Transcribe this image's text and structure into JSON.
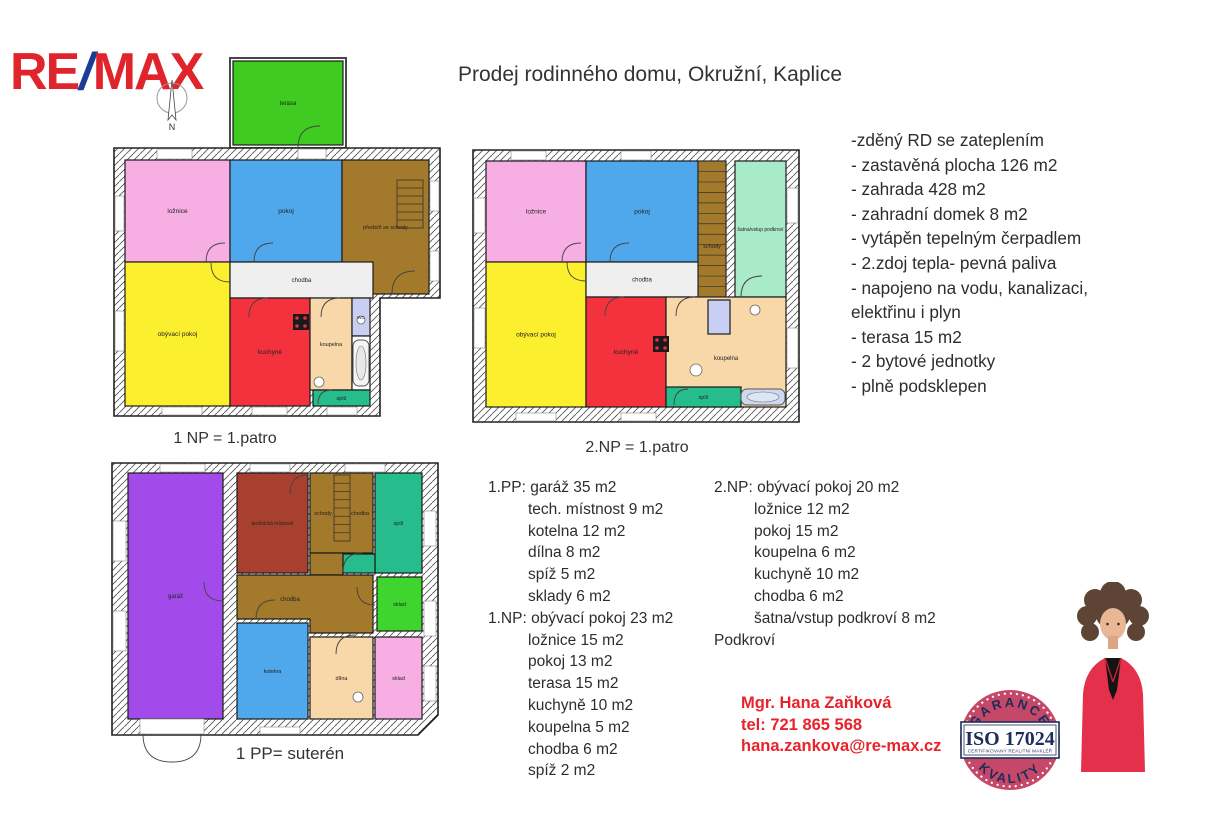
{
  "brand": {
    "re": "RE",
    "slash": "/",
    "max": "MAX"
  },
  "compass": {
    "n": "N"
  },
  "title": "Prodej rodinného domu, Okružní, Kaplice",
  "features": {
    "lines": [
      "-zděný RD se zateplením",
      "- zastavěná plocha 126 m2",
      "- zahrada 428 m2",
      "- zahradní domek 8 m2",
      "- vytápěn tepelným čerpadlem",
      "- 2.zdoj tepla- pevná paliva",
      "- napojeno na vodu, kanalizaci,",
      "elektřinu i plyn",
      "- terasa 15 m2",
      "- 2 bytové jednotky",
      "- plně podsklepen"
    ]
  },
  "room_lists": {
    "left": [
      {
        "t": "1.PP: garáž 35 m2",
        "i": 0
      },
      {
        "t": "tech. místnost 9 m2",
        "i": 1
      },
      {
        "t": "kotelna 12 m2",
        "i": 1
      },
      {
        "t": "dílna 8 m2",
        "i": 1
      },
      {
        "t": "spíž 5 m2",
        "i": 1
      },
      {
        "t": "sklady 6 m2",
        "i": 1
      },
      {
        "t": "1.NP: obývací pokoj 23 m2",
        "i": 0
      },
      {
        "t": "ložnice 15 m2",
        "i": 1
      },
      {
        "t": "pokoj 13 m2",
        "i": 1
      },
      {
        "t": "terasa 15 m2",
        "i": 1
      },
      {
        "t": "kuchyně 10 m2",
        "i": 1
      },
      {
        "t": "koupelna 5 m2",
        "i": 1
      },
      {
        "t": "chodba 6 m2",
        "i": 1
      },
      {
        "t": "spíž 2 m2",
        "i": 1
      }
    ],
    "right": [
      {
        "t": "2.NP: obývací pokoj 20 m2",
        "i": 0
      },
      {
        "t": "ložnice 12 m2",
        "i": 1
      },
      {
        "t": "pokoj 15 m2",
        "i": 1
      },
      {
        "t": "koupelna 6 m2",
        "i": 1
      },
      {
        "t": "kuchyně 10 m2",
        "i": 1
      },
      {
        "t": "chodba 6 m2",
        "i": 1
      },
      {
        "t": "šatna/vstup podkroví 8 m2",
        "i": 1
      },
      {
        "t": "Podkroví",
        "i": 0
      }
    ]
  },
  "agent": {
    "name": "Mgr. Hana Zaňková",
    "phone": "tel: 721 865 568",
    "email": "hana.zankova@re-max.cz"
  },
  "badge": {
    "arc_top": "GARANCE",
    "arc_bottom": "KVALITY",
    "code": "ISO 17024",
    "subtitle": "CERTIFIKOVANÝ REALITNÍ MAKLÉŘ",
    "ring_color": "#c54868",
    "navy": "#1b2d5b"
  },
  "floor_plans": [
    {
      "id": "plan1",
      "caption": "1 NP = 1.patro",
      "pos": {
        "left": 112,
        "top": 56,
        "w": 330,
        "h": 368
      },
      "frames": [
        {
          "x": 118,
          "y": 2,
          "w": 116,
          "h": 90
        }
      ],
      "walls": [
        "2,92 328,92 328,242 268,242 268,360 2,360"
      ],
      "rooms": [
        {
          "label": "terasa",
          "color": "#3fcb20",
          "x": 121,
          "y": 5,
          "w": 110,
          "h": 84,
          "fs": 6
        },
        {
          "label": "ložnice",
          "color": "#f7aee3",
          "x": 13,
          "y": 104,
          "w": 105,
          "h": 102
        },
        {
          "label": "pokoj",
          "color": "#4fa8ec",
          "x": 118,
          "y": 104,
          "w": 112,
          "h": 102
        },
        {
          "label": "předsíň se schody",
          "color": "#a3792b",
          "x": 230,
          "y": 104,
          "w": 87,
          "h": 134,
          "fs": 5.5
        },
        {
          "label": "obývací pokoj",
          "color": "#fcef2e",
          "x": 13,
          "y": 206,
          "w": 105,
          "h": 144
        },
        {
          "label": "chodba",
          "color": "#efefef",
          "x": 118,
          "y": 206,
          "w": 143,
          "h": 36,
          "fs": 6
        },
        {
          "label": "kuchyně",
          "color": "#f4323e",
          "x": 118,
          "y": 242,
          "w": 80,
          "h": 108
        },
        {
          "label": "koupelna",
          "color": "#f8d8a8",
          "x": 198,
          "y": 242,
          "w": 42,
          "h": 92,
          "fs": 5.5
        },
        {
          "label": "WC",
          "color": "#c9cff2",
          "x": 240,
          "y": 242,
          "w": 18,
          "h": 38,
          "fs": 4.5
        },
        {
          "label": "",
          "color": "#ffffff",
          "x": 240,
          "y": 280,
          "w": 18,
          "h": 54
        },
        {
          "label": "spíž",
          "color": "#26bc8c",
          "x": 201,
          "y": 334,
          "w": 57,
          "h": 16,
          "fs": 5.5
        }
      ],
      "windows": [
        {
          "x": 45,
          "y": 93,
          "w": 35,
          "h": 10
        },
        {
          "x": 186,
          "y": 93,
          "w": 28,
          "h": 10
        },
        {
          "x": 3,
          "y": 140,
          "w": 9,
          "h": 35
        },
        {
          "x": 3,
          "y": 255,
          "w": 9,
          "h": 40
        },
        {
          "x": 50,
          "y": 351,
          "w": 40,
          "h": 8
        },
        {
          "x": 140,
          "y": 351,
          "w": 35,
          "h": 8
        },
        {
          "x": 215,
          "y": 351,
          "w": 30,
          "h": 8
        },
        {
          "x": 318,
          "y": 125,
          "w": 9,
          "h": 30
        },
        {
          "x": 318,
          "y": 195,
          "w": 9,
          "h": 30
        }
      ],
      "doors": [
        "M94,206 Q94,187 113,187",
        "M142,206 Q142,187 161,187",
        "M118,226 Q99,226 99,207",
        "M137,261 Q137,242 156,242",
        "M209,261 Q209,242 228,242",
        "M206,348 Q206,334 220,334",
        "M280,238 Q280,215 303,215",
        "M186,92 Q186,70 208,70"
      ],
      "fixtures": [
        {
          "type": "stairs-v",
          "x": 285,
          "y": 124,
          "w": 26,
          "h": 48,
          "n": 6
        },
        {
          "type": "tub-v",
          "x": 241,
          "y": 284,
          "w": 16,
          "h": 46
        },
        {
          "type": "stove",
          "x": 181,
          "y": 258,
          "w": 16,
          "h": 16
        },
        {
          "type": "basin",
          "x": 207,
          "y": 326,
          "r": 5
        },
        {
          "type": "basin",
          "x": 249,
          "y": 264,
          "r": 4
        }
      ],
      "texts": []
    },
    {
      "id": "plan2",
      "caption": "2.NP = 1.patro",
      "pos": {
        "left": 471,
        "top": 148,
        "w": 330,
        "h": 276
      },
      "frames": [],
      "walls": [
        "2,2 328,2 328,274 2,274"
      ],
      "rooms": [
        {
          "label": "ložnice",
          "color": "#f7aee3",
          "x": 15,
          "y": 13,
          "w": 100,
          "h": 101
        },
        {
          "label": "pokoj",
          "color": "#4fa8ec",
          "x": 115,
          "y": 13,
          "w": 112,
          "h": 101
        },
        {
          "label": "schody",
          "color": "#a3792b",
          "x": 227,
          "y": 13,
          "w": 28,
          "h": 136,
          "fs": 5.5,
          "ly": 100
        },
        {
          "label": "šatna/vstup podkroví",
          "color": "#a9ebc8",
          "x": 264,
          "y": 13,
          "w": 51,
          "h": 136,
          "fs": 5
        },
        {
          "label": "obývací pokoj",
          "color": "#fcef2e",
          "x": 15,
          "y": 114,
          "w": 100,
          "h": 145
        },
        {
          "label": "chodba",
          "color": "#efefef",
          "x": 115,
          "y": 114,
          "w": 112,
          "h": 35,
          "fs": 6
        },
        {
          "label": "kuchyně",
          "color": "#f4323e",
          "x": 115,
          "y": 149,
          "w": 80,
          "h": 110
        },
        {
          "label": "koupelna",
          "color": "#f8d8a8",
          "x": 195,
          "y": 149,
          "w": 120,
          "h": 110,
          "fs": 6,
          "ly": 212
        },
        {
          "label": "",
          "color": "#c9cff2",
          "x": 237,
          "y": 152,
          "w": 22,
          "h": 34
        },
        {
          "label": "spíž",
          "color": "#26bc8c",
          "x": 195,
          "y": 239,
          "w": 75,
          "h": 20,
          "fs": 5.5
        }
      ],
      "windows": [
        {
          "x": 40,
          "y": 3,
          "w": 35,
          "h": 9
        },
        {
          "x": 150,
          "y": 3,
          "w": 30,
          "h": 9
        },
        {
          "x": 3,
          "y": 50,
          "w": 11,
          "h": 35
        },
        {
          "x": 3,
          "y": 160,
          "w": 11,
          "h": 40
        },
        {
          "x": 45,
          "y": 265,
          "w": 40,
          "h": 8
        },
        {
          "x": 150,
          "y": 265,
          "w": 35,
          "h": 8
        },
        {
          "x": 316,
          "y": 40,
          "w": 11,
          "h": 35
        },
        {
          "x": 316,
          "y": 180,
          "w": 11,
          "h": 40
        }
      ],
      "doors": [
        "M91,114 Q91,95 110,95",
        "M139,114 Q139,95 158,95",
        "M115,133 Q96,133 96,114",
        "M134,168 Q134,149 153,149",
        "M205,168 Q205,149 224,149",
        "M270,149 Q270,128 291,128",
        "M203,257 Q203,241 217,241"
      ],
      "fixtures": [
        {
          "type": "stairs-v",
          "x": 227,
          "y": 13,
          "w": 28,
          "h": 136,
          "n": 13
        },
        {
          "type": "tub-h",
          "x": 270,
          "y": 241,
          "w": 44,
          "h": 16
        },
        {
          "type": "stove",
          "x": 182,
          "y": 188,
          "w": 16,
          "h": 16
        },
        {
          "type": "basin",
          "x": 225,
          "y": 222,
          "r": 6
        },
        {
          "type": "basin",
          "x": 284,
          "y": 162,
          "r": 5
        }
      ],
      "texts": []
    },
    {
      "id": "plan3",
      "caption": "1 PP= suterén",
      "pos": {
        "left": 110,
        "top": 461,
        "w": 330,
        "h": 304
      },
      "frames": [],
      "walls": [
        "2,2 328,2 328,254 308,274 2,274"
      ],
      "rooms": [
        {
          "label": "garáž",
          "color": "#a34bea",
          "x": 18,
          "y": 12,
          "w": 95,
          "h": 246,
          "fs": 6
        },
        {
          "label": "technická místnost",
          "color": "#a8402f",
          "x": 127,
          "y": 12,
          "w": 71,
          "h": 100,
          "fs": 5
        },
        {
          "label": "",
          "color": "#a3792b",
          "x": 200,
          "y": 12,
          "w": 63,
          "h": 80
        },
        {
          "label": "",
          "color": "#a3792b",
          "x": 200,
          "y": 92,
          "w": 33,
          "h": 22
        },
        {
          "label": "spíž",
          "color": "#26bc8c",
          "x": 265,
          "y": 12,
          "w": 47,
          "h": 100,
          "fs": 5.5
        },
        {
          "label": "",
          "color": "#26bc8c",
          "x": 233,
          "y": 93,
          "w": 32,
          "h": 19
        },
        {
          "label": "chodba",
          "color": "#a3792b",
          "pts": "127,114 263,114 263,172 200,172 200,158 127,158",
          "lx": 180,
          "ly": 140,
          "fs": 6
        },
        {
          "label": "sklad",
          "color": "#3fd52f",
          "x": 267,
          "y": 116,
          "w": 45,
          "h": 54,
          "fs": 5.5
        },
        {
          "label": "kotelna",
          "color": "#4fa8ec",
          "x": 127,
          "y": 162,
          "w": 71,
          "h": 96,
          "fs": 5.5
        },
        {
          "label": "dílna",
          "color": "#f8d8a8",
          "x": 200,
          "y": 176,
          "w": 63,
          "h": 82,
          "fs": 5.5
        },
        {
          "label": "sklad",
          "color": "#f7aee3",
          "x": 265,
          "y": 176,
          "w": 47,
          "h": 82,
          "fs": 5.5
        }
      ],
      "windows": [
        {
          "x": 3,
          "y": 60,
          "w": 13,
          "h": 40
        },
        {
          "x": 3,
          "y": 150,
          "w": 13,
          "h": 40
        },
        {
          "x": 50,
          "y": 3,
          "w": 45,
          "h": 8
        },
        {
          "x": 140,
          "y": 3,
          "w": 40,
          "h": 8
        },
        {
          "x": 235,
          "y": 3,
          "w": 40,
          "h": 8
        },
        {
          "x": 314,
          "y": 50,
          "w": 12,
          "h": 35
        },
        {
          "x": 314,
          "y": 140,
          "w": 12,
          "h": 35
        },
        {
          "x": 314,
          "y": 205,
          "w": 12,
          "h": 35
        },
        {
          "x": 150,
          "y": 266,
          "w": 40,
          "h": 7
        },
        {
          "x": 30,
          "y": 258,
          "w": 64,
          "h": 15
        }
      ],
      "doors": [
        "M94,121 Q94,140 113,140",
        "M180,33 Q180,14 198,14",
        "M233,111 Q233,92 252,92",
        "M265,144 Q247,144 247,126",
        "M146,158 Q146,139 165,139",
        "M226,193 Q226,174 245,174",
        "M33,273 Q33,301 62,301",
        "M91,273 Q91,301 62,301"
      ],
      "fixtures": [
        {
          "type": "stairs-v",
          "x": 224,
          "y": 14,
          "w": 16,
          "h": 66,
          "n": 8
        },
        {
          "type": "basin",
          "x": 248,
          "y": 236,
          "r": 5
        }
      ],
      "texts": [
        {
          "t": "schody",
          "x": 213,
          "y": 54,
          "fs": 5.5
        },
        {
          "t": "chodba",
          "x": 250,
          "y": 54,
          "fs": 5.5
        }
      ]
    }
  ]
}
